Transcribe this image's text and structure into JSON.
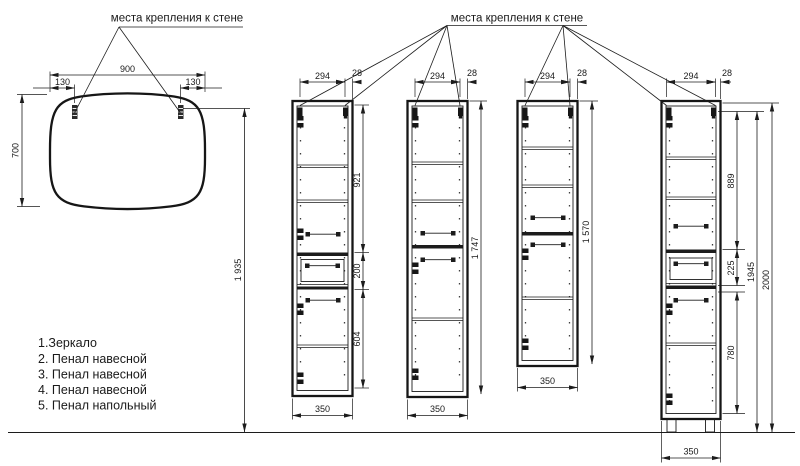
{
  "notes": {
    "left": "места крепления к стене",
    "right": "места крепления к стене"
  },
  "mirror": {
    "width": "900",
    "offset_left": "130",
    "offset_right": "130",
    "height": "700",
    "mount_height": "1 935"
  },
  "cab2": {
    "span": "294",
    "offset": "28",
    "top_section": "921",
    "drawer_section": "200",
    "bottom_section": "604",
    "width": "350"
  },
  "cab3": {
    "span": "294",
    "offset": "28",
    "height": "1 747",
    "width": "350"
  },
  "cab4": {
    "span": "294",
    "offset": "28",
    "height": "1 570",
    "width": "350"
  },
  "cab5": {
    "span": "294",
    "offset": "28",
    "top_section": "889",
    "drawer_section": "225",
    "bottom_section": "780",
    "body_height": "1945",
    "total_height": "2000",
    "width": "350"
  },
  "legend": {
    "i1": "1.Зеркало",
    "i2": "2. Пенал навесной",
    "i3": "3. Пенал навесной",
    "i4": "4. Пенал навесной",
    "i5": "5. Пенал напольный"
  }
}
